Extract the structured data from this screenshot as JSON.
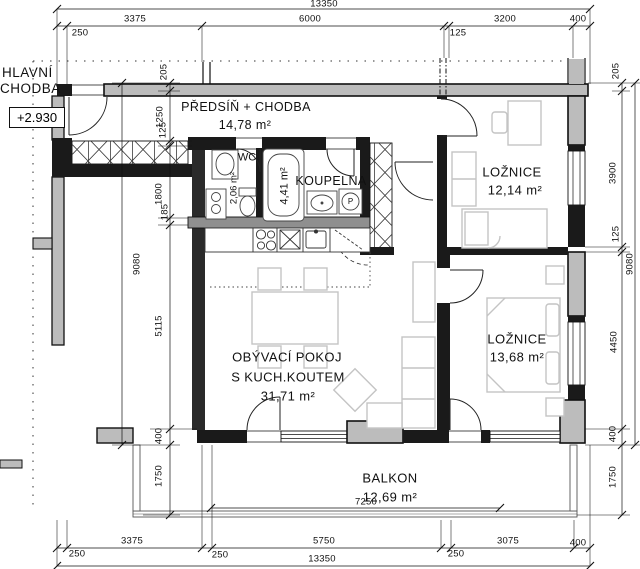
{
  "labels": {
    "corridor_line1": "HLAVNÍ",
    "corridor_line2": "CHODBA",
    "elevation": "+2.930",
    "washer_letter": "P"
  },
  "rooms": {
    "hall": {
      "name": "PŘEDSÍŇ + CHODBA",
      "area": "14,78 m²"
    },
    "wc": {
      "name": "WC",
      "area": "2,06 m²"
    },
    "bathroom": {
      "name": "KOUPELNA",
      "area": "4,41 m²"
    },
    "bedroom1": {
      "name": "LOŽNICE",
      "area": "12,14 m²"
    },
    "bedroom2": {
      "name": "LOŽNICE",
      "area": "13,68 m²"
    },
    "living": {
      "name_line1": "OBÝVACÍ POKOJ",
      "name_line2": "S KUCH.KOUTEM",
      "area": "31,71 m²"
    },
    "balcony": {
      "name": "BALKON",
      "area": "12,69 m²",
      "width_label": "7250"
    }
  },
  "dims": {
    "top_total": "13350",
    "top_250": "250",
    "top_3375": "3375",
    "top_6000": "6000",
    "top_125": "125",
    "top_3200": "3200",
    "top_400": "400",
    "bottom_250a": "250",
    "bottom_3375": "3375",
    "bottom_250b": "250",
    "bottom_5750": "5750",
    "bottom_250c": "250",
    "bottom_3075": "3075",
    "bottom_400": "400",
    "bottom_total": "13350",
    "left_205": "205",
    "left_1250": "1250",
    "left_125": "125",
    "left_1800": "1800",
    "left_185": "185",
    "left_5115": "5115",
    "left_400": "400",
    "left_total": "9080",
    "left_1750": "1750",
    "right_205": "205",
    "right_3900": "3900",
    "right_125": "125",
    "right_4450": "4450",
    "right_400": "400",
    "right_total": "9080",
    "right_1750": "1750"
  },
  "colors": {
    "wall_fill": "#bcbcbc",
    "wall_line": "#111111",
    "furniture": "#c4c4c4"
  }
}
